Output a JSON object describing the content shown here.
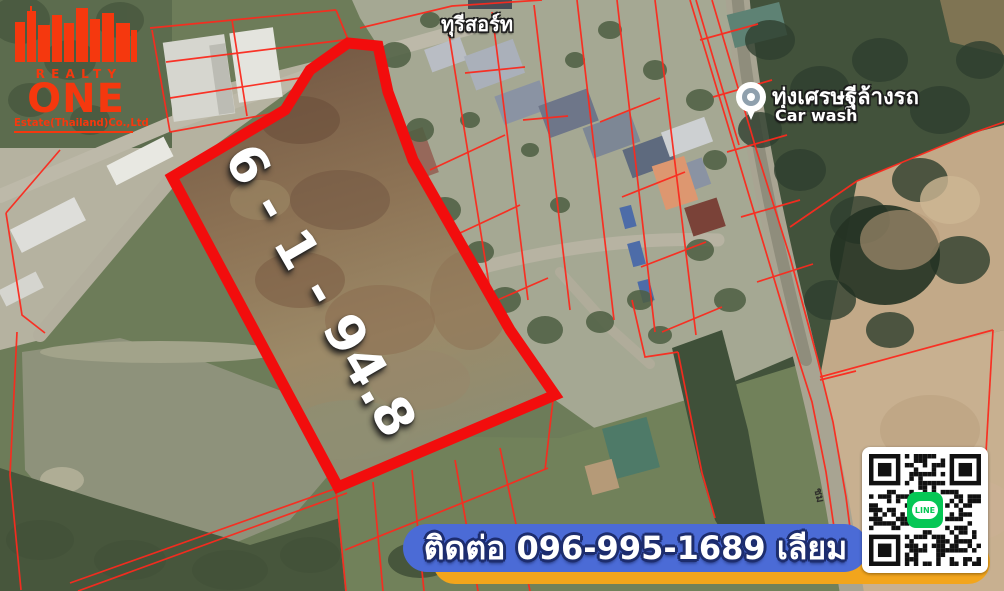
{
  "logo": {
    "brand_top": "REALTY",
    "brand_main": "ONE",
    "brand_sub": "Estate(Thailand)Co.,Ltd",
    "color": "#f5380e"
  },
  "map_labels": {
    "resort": "ทุรีสอร์ท",
    "carwash_thai": "ทุ่งเศรษฐีล้างรถ",
    "carwash_en": "Car wash",
    "road_label": "ชม"
  },
  "plot": {
    "area_label": "6 - 1 - 94.8",
    "boundary_color": "#f20d0d",
    "parcel_line_color": "#fb2a1e"
  },
  "contact": {
    "banner_text": "ติดต่อ 096-995-1689 เลียม",
    "banner_bg": "#4b6bd6",
    "banner_accent": "#f2a51c"
  },
  "qr": {
    "app_label": "LINE",
    "app_color": "#06C755"
  }
}
